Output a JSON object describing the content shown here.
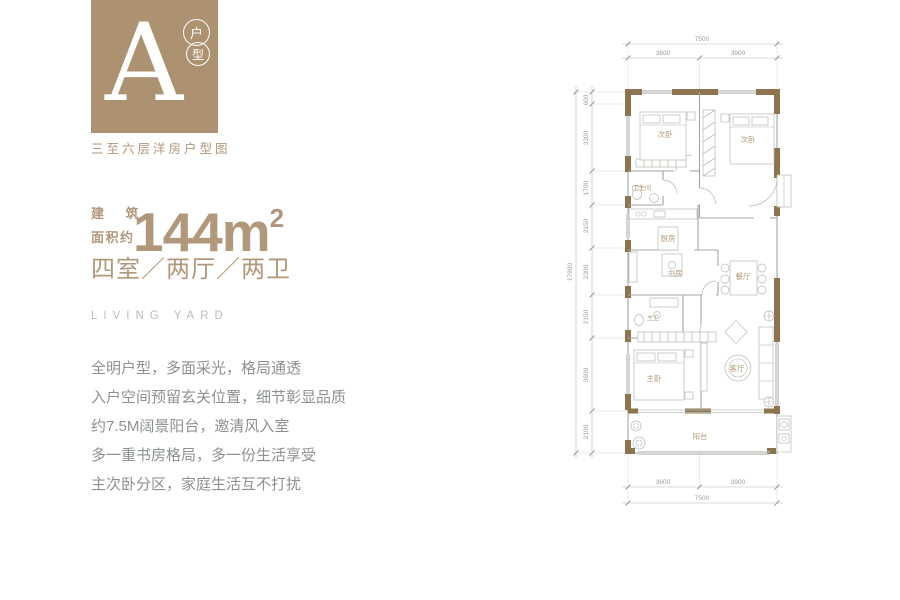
{
  "colors": {
    "tan": "#b2987a",
    "badge_bg": "#ad9271",
    "text_gray": "#8c9290",
    "tagline_gray": "#b8beba",
    "wall_brown": "#8d744f",
    "dim_gray": "#9aa09b"
  },
  "header": {
    "badge_letter": "A",
    "badge_circle_top": "户",
    "badge_circle_bottom": "型",
    "series_caption": "三至六层洋房户型图"
  },
  "area": {
    "label_line1": "建 筑",
    "label_line2": "面积约",
    "value": "144m",
    "superscript": "2",
    "layout": "四室／两厅／两卫"
  },
  "tagline": "LIVING YARD",
  "features": [
    "全明户型，多面采光，格局通透",
    "入户空间预留玄关位置，细节彰显品质",
    "约7.5M阔景阳台，邀清风入室",
    "多一重书房格局，多一份生活享受",
    "主次卧分区，家庭生活互不打扰"
  ],
  "floor_plan": {
    "dims_top": {
      "total": "7500",
      "seg_left": "3600",
      "seg_right": "3900"
    },
    "dims_bottom": {
      "total": "7500",
      "seg_left": "3600",
      "seg_right": "3900"
    },
    "dims_left": {
      "total": "17900",
      "segments": [
        "600",
        "3300",
        "1700",
        "2150",
        "2300",
        "2150",
        "3600",
        "2100"
      ]
    },
    "rooms": [
      "次卧",
      "次卧",
      "卫生间",
      "厨房",
      "书房",
      "餐厅",
      "主卫",
      "主卧",
      "客厅",
      "阳台"
    ]
  }
}
